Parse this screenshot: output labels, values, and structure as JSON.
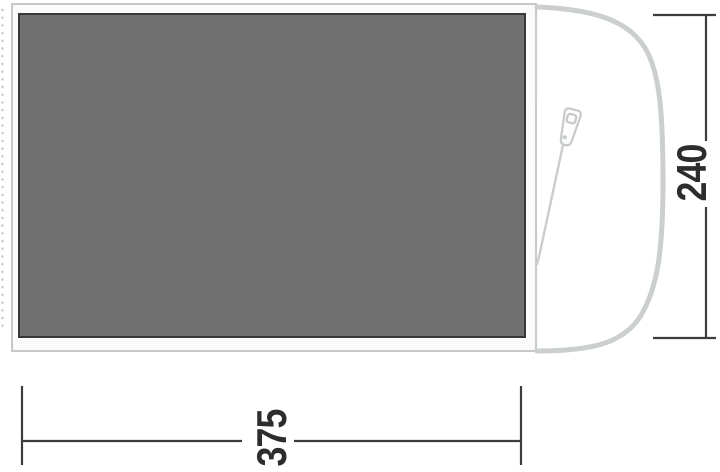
{
  "diagram": {
    "title": "tent-floorplan-top-view",
    "labels": {
      "width": "375",
      "height": "240"
    },
    "icons": {
      "zipper": "zipper-pull-icon"
    },
    "colors": {
      "background": "#ffffff",
      "groundsheet_fill": "#707070",
      "groundsheet_border": "#383838",
      "frame_fill": "#fafbfa",
      "tent_outline": "#c6cac8",
      "porch_outline": "#cbcfcd",
      "dotted_seam": "#c4c8c6",
      "dimension_line": "#3d3d3d",
      "dimension_text": "#2d2d2d"
    }
  }
}
